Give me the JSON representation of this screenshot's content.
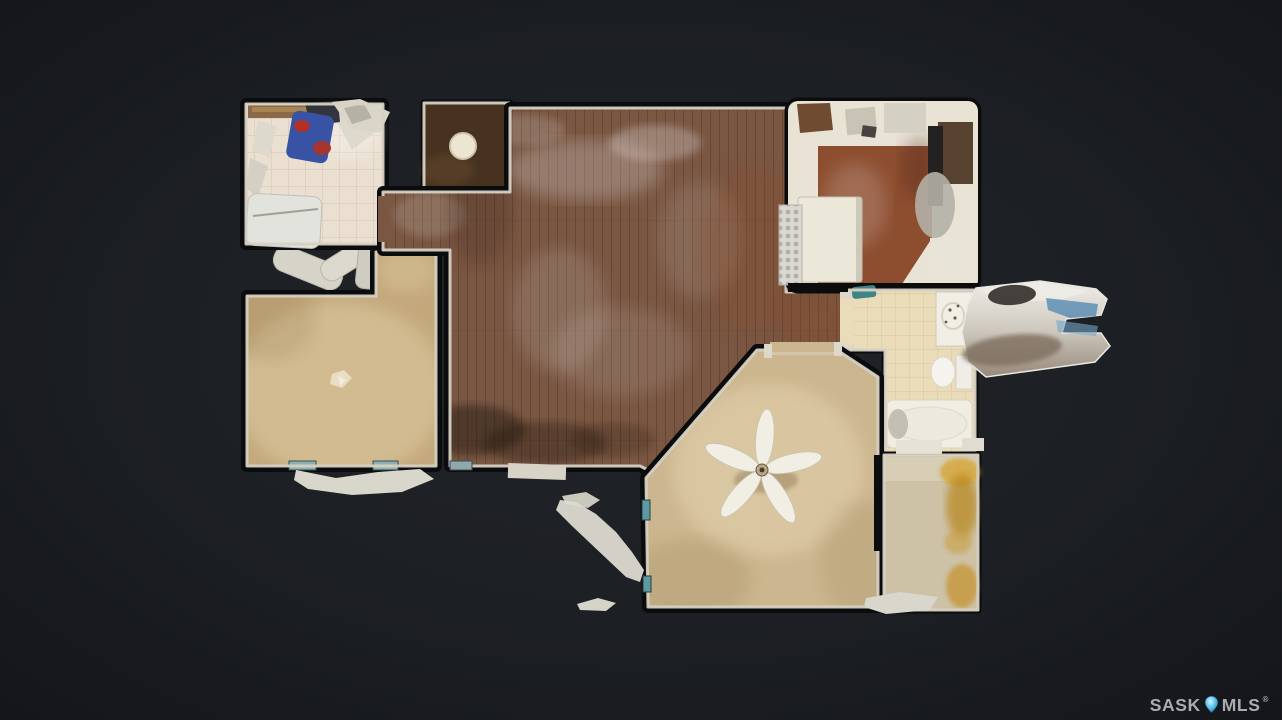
{
  "page": {
    "background_color": "#1f2226",
    "vignette_color": "#141619"
  },
  "watermark": {
    "brand_left": "SASK",
    "brand_right": "MLS",
    "registered_mark": "®",
    "text_color": "#a9acb1",
    "pin_color": "#2f9fd4"
  },
  "floorplan": {
    "view": "top-down 3D scan floor plan",
    "wall_trim_color": "#d6d1c3",
    "wall_shadow_color": "#0b0c0d",
    "rooms": [
      {
        "id": "laundry-room",
        "label": "laundry / utility room",
        "floor": "tile",
        "color": "#eadfd1"
      },
      {
        "id": "bedroom-left",
        "label": "bedroom (left)",
        "floor": "carpet",
        "color": "#c3a87c"
      },
      {
        "id": "entry",
        "label": "entry landing",
        "floor": "dark mat",
        "color": "#46321f"
      },
      {
        "id": "living-dining",
        "label": "living / dining area",
        "floor": "hardwood",
        "color": "#7a5743"
      },
      {
        "id": "kitchen",
        "label": "kitchen floor",
        "floor": "hardwood",
        "color": "#8d4e30"
      },
      {
        "id": "kitchen-counters",
        "label": "kitchen counters",
        "floor": "",
        "color": "#e9e3d5"
      },
      {
        "id": "bathroom",
        "label": "bathroom",
        "floor": "tile",
        "color": "#eadcb9"
      },
      {
        "id": "bedroom-primary",
        "label": "primary bedroom",
        "floor": "carpet",
        "color": "#ccb68f"
      },
      {
        "id": "bedroom-right",
        "label": "bedroom (bottom right)",
        "floor": "carpet",
        "color": "#cdc2a6"
      },
      {
        "id": "stairwell",
        "label": "stairwell (scan blur)",
        "floor": "",
        "color": "#c9c2b6"
      }
    ],
    "fixtures": [
      "ceiling-fan",
      "entry-ceiling-light",
      "kitchen-island",
      "refrigerator",
      "bathroom-vanity",
      "toilet",
      "bathtub",
      "chest-freezer",
      "closet-doors"
    ]
  }
}
